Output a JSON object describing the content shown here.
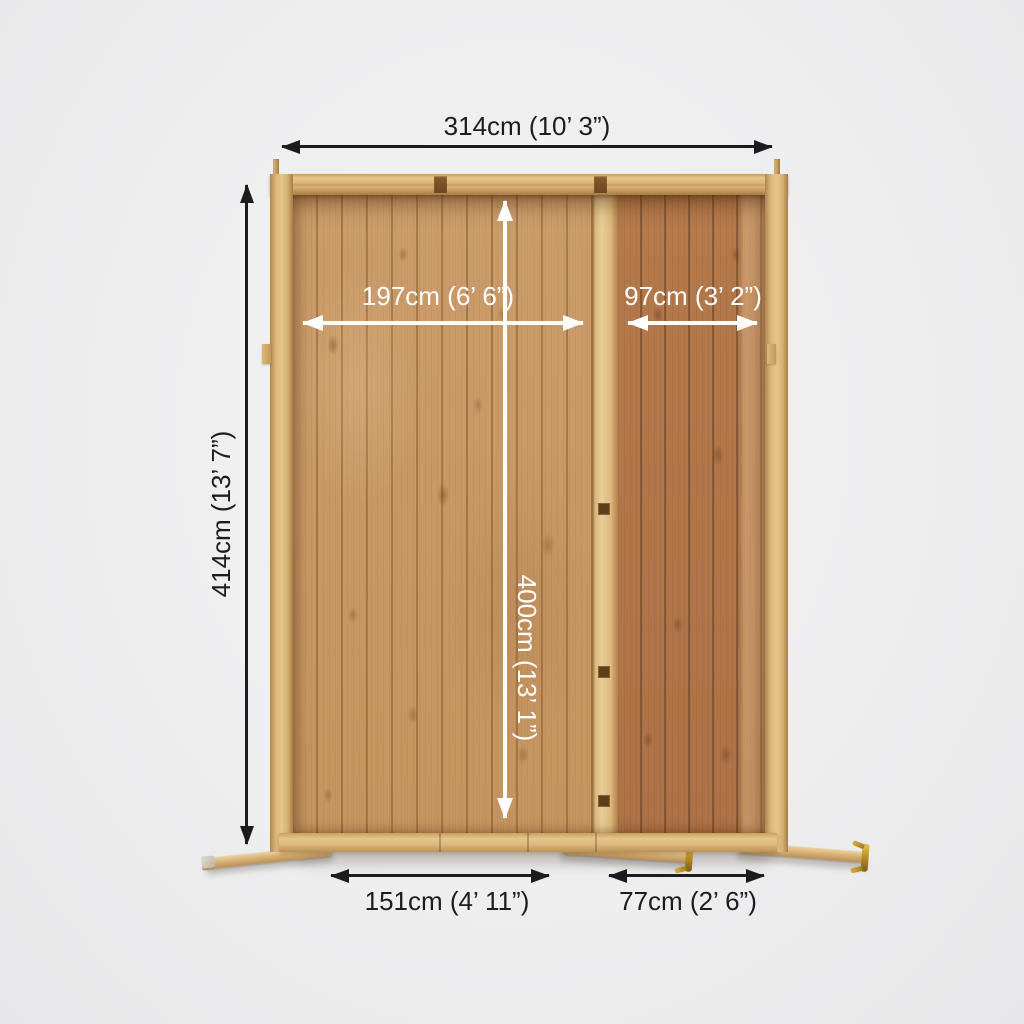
{
  "annotations": {
    "overall_width": "314cm (10’ 3”)",
    "overall_depth": "414cm (13’ 7”)",
    "interior_main_width": "197cm (6’ 6”)",
    "interior_side_width": "97cm (3’ 2”)",
    "interior_depth": "400cm (13’ 1”)",
    "door_main_width": "151cm (4’ 11”)",
    "door_side_width": "77cm (2’ 6”)"
  },
  "colors": {
    "background": "#efeff0",
    "dimension_dark": "#1c1c1e",
    "dimension_light": "#ffffff",
    "wood_frame": "#d9b67c",
    "wood_floor_main": "#c89861",
    "wood_floor_side": "#b07547",
    "wood_divider": "#e0c089",
    "brass_hinge": "#c79a2e"
  }
}
